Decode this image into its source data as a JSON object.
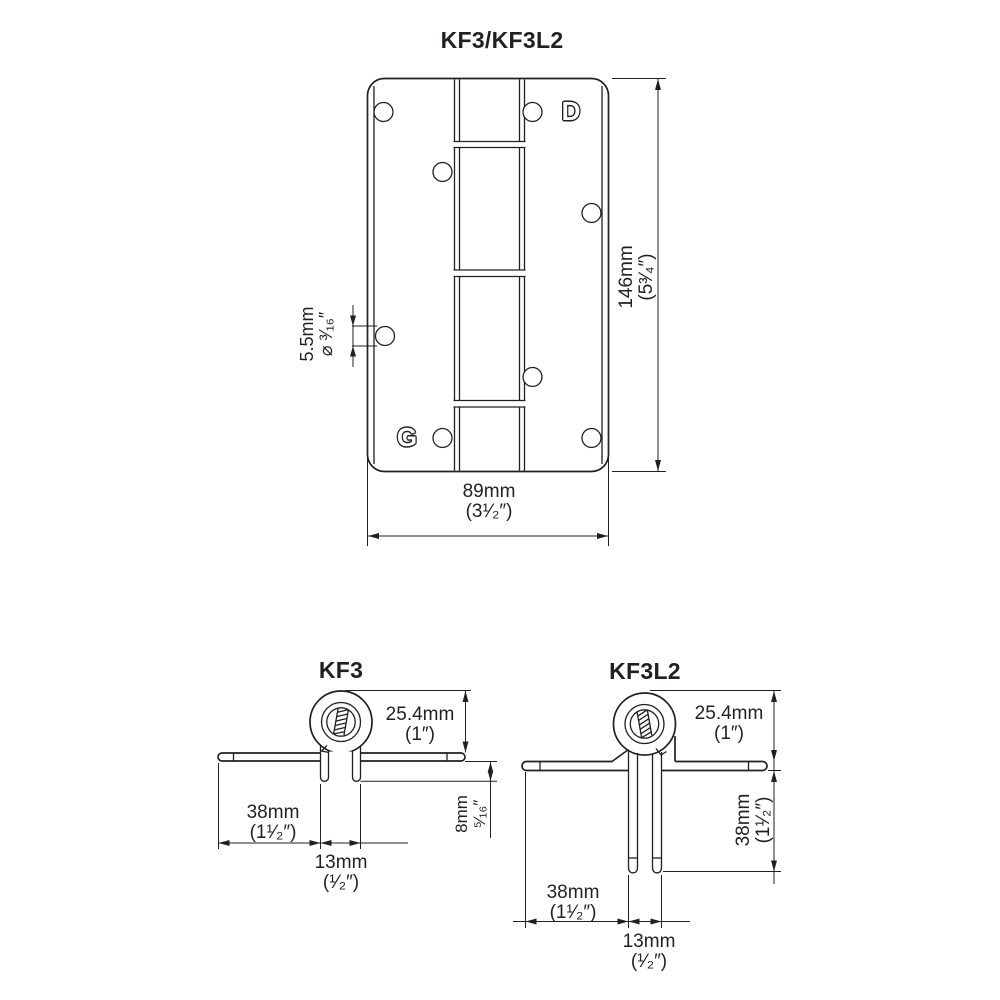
{
  "top_view": {
    "title": "KF3/KF3L2",
    "logo_top": "D",
    "logo_bottom": "G",
    "height_mm": "146mm",
    "height_in": "(5³⁄₄″)",
    "width_mm": "89mm",
    "width_in": "(3¹⁄₂″)",
    "hole_mm": "5.5mm",
    "hole_in": "⌀ ³⁄₁₆″"
  },
  "kf3": {
    "title": "KF3",
    "knuckle_mm": "25.4mm",
    "knuckle_in": "(1″)",
    "leaf_mm": "38mm",
    "leaf_in": "(1¹⁄₂″)",
    "pins_mm": "13mm",
    "pins_in": "(¹⁄₂″)",
    "lug_mm": "8mm",
    "lug_in": "⁵⁄₁₆″"
  },
  "kf3l2": {
    "title": "KF3L2",
    "knuckle_mm": "25.4mm",
    "knuckle_in": "(1″)",
    "leg_mm": "38mm",
    "leg_in": "(1¹⁄₂″)",
    "leaf_mm": "38mm",
    "leaf_in": "(1¹⁄₂″)",
    "pins_mm": "13mm",
    "pins_in": "(¹⁄₂″)"
  },
  "colors": {
    "line": "#231f20",
    "background": "#ffffff"
  }
}
